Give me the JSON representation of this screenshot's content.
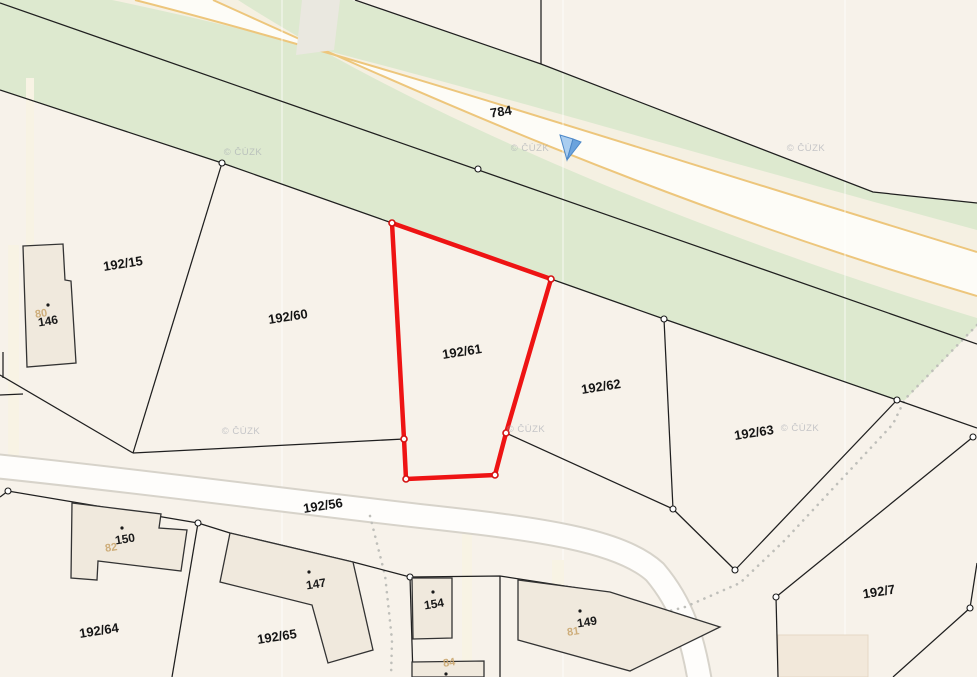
{
  "map_type": "cadastral-map-viewer",
  "watermark": {
    "text": "© ČÚZK"
  },
  "selected_parcel": "192/61",
  "labels": {
    "parcels": [
      "784",
      "192/15",
      "192/60",
      "192/61",
      "192/62",
      "192/63",
      "192/7",
      "192/56",
      "192/64",
      "192/65"
    ],
    "buildings": [
      "146",
      "150",
      "147",
      "154",
      "149"
    ],
    "house_numbers": [
      "80",
      "82",
      "81",
      "84"
    ]
  },
  "colors": {
    "background": "#f7f2ea",
    "greenway": "#dde9cf",
    "road_fill": "#fdfcf7",
    "road_edge_orange": "#edc67c",
    "local_road_casing": "#d7d3ca",
    "highlight_red": "#ee1414",
    "building_fill": "#f0e9dd",
    "boundary_black": "#1f1f1f"
  }
}
